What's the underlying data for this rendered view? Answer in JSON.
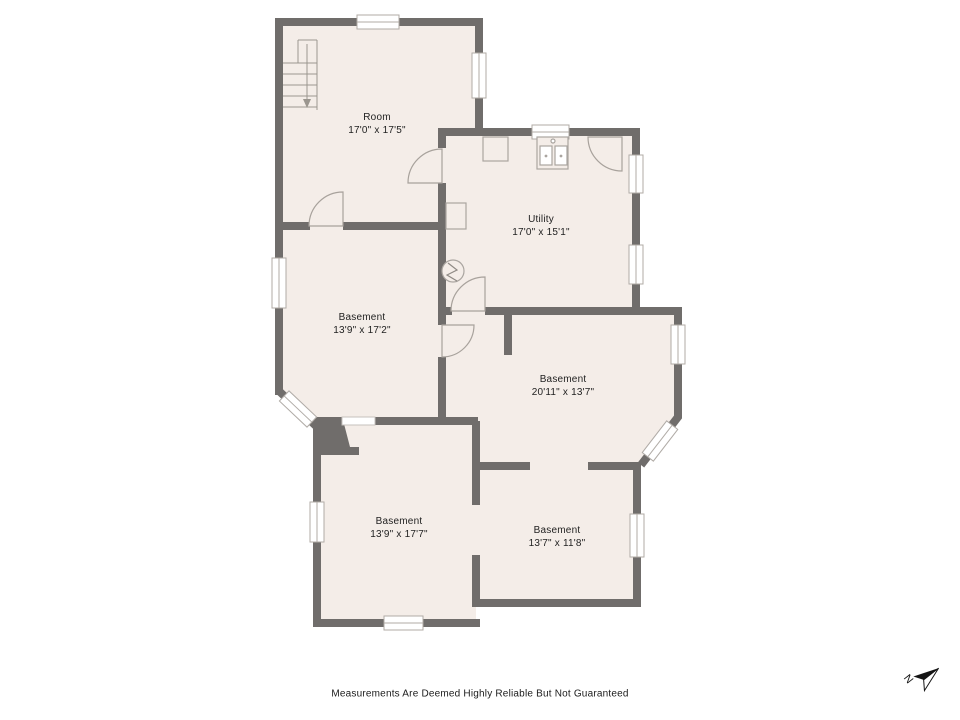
{
  "rooms": [
    {
      "id": "room",
      "name": "Room",
      "dimensions": "17'0\" x 17'5\""
    },
    {
      "id": "utility",
      "name": "Utility",
      "dimensions": "17'0\" x 15'1\""
    },
    {
      "id": "basement-ml",
      "name": "Basement",
      "dimensions": "13'9\" x 17'2\""
    },
    {
      "id": "basement-mr",
      "name": "Basement",
      "dimensions": "20'11\" x 13'7\""
    },
    {
      "id": "basement-bl",
      "name": "Basement",
      "dimensions": "13'9\" x 17'7\""
    },
    {
      "id": "basement-br",
      "name": "Basement",
      "dimensions": "13'7\" x 11'8\""
    }
  ],
  "footer": {
    "disclaimer": "Measurements Are Deemed Highly Reliable But Not Guaranteed"
  },
  "compass": {
    "label": "N"
  },
  "fixtures": [
    "staircase",
    "sink",
    "appliance",
    "storage-unit",
    "sump-pump",
    "chimney"
  ],
  "colors": {
    "background": "#ffffff",
    "floor": "#f4ede8",
    "wall": "#706d6b",
    "window_frame": "#b0aba6",
    "door_line": "#a8a29c",
    "text": "#1f1f1f"
  }
}
